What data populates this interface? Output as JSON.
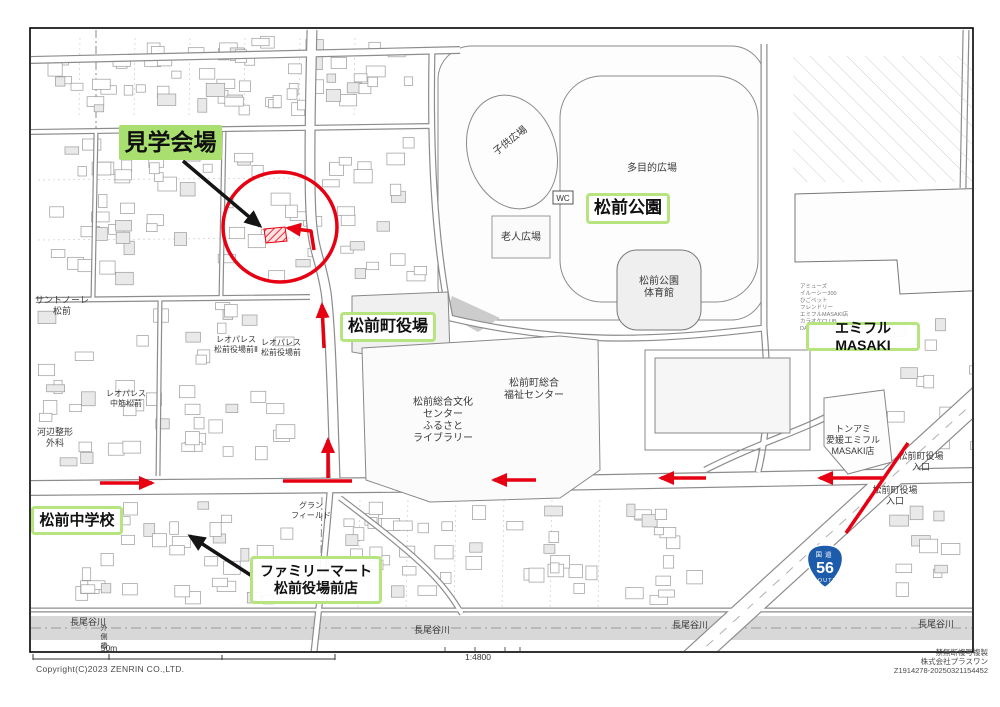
{
  "overlay_labels": [
    {
      "name": "venue-label",
      "lines": [
        "見学会場"
      ],
      "x": 119,
      "y": 125,
      "w": 103,
      "h": 35,
      "fs": 23,
      "style": "solid"
    },
    {
      "name": "park-label",
      "lines": [
        "松前公園"
      ],
      "x": 586,
      "y": 193,
      "w": 84,
      "h": 31,
      "fs": 17,
      "style": "outline"
    },
    {
      "name": "townhall-label",
      "lines": [
        "松前町役場"
      ],
      "x": 340,
      "y": 312,
      "w": 96,
      "h": 30,
      "fs": 16,
      "style": "outline"
    },
    {
      "name": "emifull-label",
      "lines": [
        "エミフルMASAKI"
      ],
      "x": 806,
      "y": 322,
      "w": 114,
      "h": 29,
      "fs": 14,
      "style": "outline"
    },
    {
      "name": "school-label",
      "lines": [
        "松前中学校"
      ],
      "x": 31,
      "y": 506,
      "w": 92,
      "h": 29,
      "fs": 15,
      "style": "outline"
    },
    {
      "name": "familymart-label",
      "lines": [
        "ファミリーマート",
        "松前役場前店"
      ],
      "x": 250,
      "y": 556,
      "w": 132,
      "h": 48,
      "fs": 14,
      "style": "outline"
    }
  ],
  "map_labels": [
    {
      "lines": [
        "子供広場"
      ],
      "x": 512,
      "y": 143,
      "s": 10,
      "rot": -38
    },
    {
      "lines": [
        "多目的広場"
      ],
      "x": 652,
      "y": 171,
      "s": 10
    },
    {
      "lines": [
        "松前公園",
        "体育館"
      ],
      "x": 659,
      "y": 284,
      "s": 10
    },
    {
      "lines": [
        "老人広場"
      ],
      "x": 521,
      "y": 240,
      "s": 10
    },
    {
      "lines": [
        "松前総合文化",
        "センター",
        "ふるさと",
        "ライブラリー"
      ],
      "x": 443,
      "y": 405,
      "s": 10
    },
    {
      "lines": [
        "松前町総合",
        "福祉センター"
      ],
      "x": 534,
      "y": 386,
      "s": 10
    },
    {
      "lines": [
        "トンアミ",
        "愛媛エミフル",
        "MASAKI店"
      ],
      "x": 853,
      "y": 432,
      "s": 9
    },
    {
      "lines": [
        "松前町役場",
        "入口"
      ],
      "x": 921,
      "y": 459,
      "s": 9
    },
    {
      "lines": [
        "松前町役場",
        "入口"
      ],
      "x": 895,
      "y": 493,
      "s": 9
    },
    {
      "lines": [
        "サントノーレ",
        "松前"
      ],
      "x": 62,
      "y": 303,
      "s": 9
    },
    {
      "lines": [
        "レオパレス",
        "松前役場前Ⅱ"
      ],
      "x": 236,
      "y": 342,
      "s": 8
    },
    {
      "lines": [
        "レオパレス",
        "松前役場前"
      ],
      "x": 281,
      "y": 345,
      "s": 8
    },
    {
      "lines": [
        "レオパレス",
        "中筋松前"
      ],
      "x": 126,
      "y": 396,
      "s": 8
    },
    {
      "lines": [
        "河辺整形",
        "外科"
      ],
      "x": 55,
      "y": 435,
      "s": 9
    },
    {
      "lines": [
        "グラン",
        "フィールド"
      ],
      "x": 311,
      "y": 508,
      "s": 8
    },
    {
      "lines": [
        "長尾谷川"
      ],
      "x": 88,
      "y": 625,
      "s": 9
    },
    {
      "lines": [
        "長尾谷川"
      ],
      "x": 432,
      "y": 633,
      "s": 9
    },
    {
      "lines": [
        "長尾谷川"
      ],
      "x": 690,
      "y": 628,
      "s": 9
    },
    {
      "lines": [
        "長尾谷川"
      ],
      "x": 936,
      "y": 627,
      "s": 9
    },
    {
      "lines": [
        "外",
        "側",
        "橋"
      ],
      "x": 104,
      "y": 630,
      "s": 7
    }
  ],
  "wc_label": "WC",
  "emifull_tenants": [
    "アミューズ",
    "イルーシー300",
    "ひごペット",
    "フレンドリー",
    "エミフルMASAKI店",
    "カラオケCLUB",
    "DAMエミフルMASAKI店"
  ],
  "route56_badge": {
    "top": "国道",
    "num": "56",
    "bottom": "ROUTE"
  },
  "route_overlay": {
    "circle": {
      "cx": 280,
      "cy": 227,
      "rx": 57,
      "ry": 55
    },
    "venue_building": "264,229 285,227 287,241 266,243",
    "segments": [
      {
        "pts": "100,483 152,483",
        "head": true
      },
      {
        "pts": "283,481 352,481",
        "head": false
      },
      {
        "pts": "328,478 328,440",
        "head": true
      },
      {
        "pts": "324,348 322,305",
        "head": true
      },
      {
        "pts": "536,480 494,480",
        "head": true
      },
      {
        "pts": "706,478 661,478",
        "head": true
      },
      {
        "pts": "884,478 820,478",
        "head": true
      },
      {
        "pts": "908,443 846,533",
        "head": false
      },
      {
        "pts": "314,250 311,231 288,228",
        "head": true
      }
    ],
    "black_arrows": [
      {
        "pts": "183,161 260,226"
      },
      {
        "pts": "252,576 190,536"
      }
    ]
  },
  "footer": {
    "scale_label": "50m",
    "scale_ratio": "1:4800",
    "copyright": "Copyright(C)2023 ZENRIN CO.,LTD.",
    "right_lines": [
      "禁無断複写複製",
      "株式会社プラスワン",
      "Z1914278-20250321154452"
    ]
  },
  "colors": {
    "route_red": "#e60012",
    "label_green": "#a9df6f",
    "label_green_border": "#b6e47e",
    "badge_blue": "#1d5bab"
  }
}
